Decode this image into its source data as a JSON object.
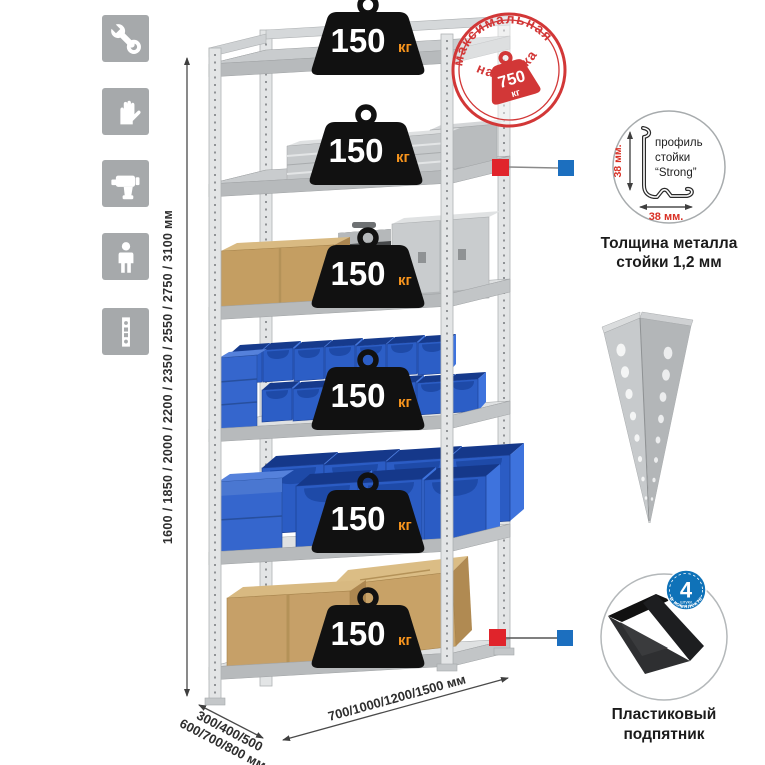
{
  "features_icons": [
    {
      "name": "wrench-icon"
    },
    {
      "name": "gloves-icon"
    },
    {
      "name": "drill-icon"
    },
    {
      "name": "person-icon"
    },
    {
      "name": "upright-profile-icon"
    }
  ],
  "dimensions": {
    "height_label": "1600 / 1850 / 2000 / 2200 / 2350 / 2550 / 2750 / 3100 мм",
    "depth_label_line1": "300/400/500",
    "depth_label_line2": "600/700/800 мм",
    "width_label": "700/1000/1200/1500 мм"
  },
  "shelf_badges": {
    "unit": "кг",
    "items": [
      {
        "value": "150"
      },
      {
        "value": "150"
      },
      {
        "value": "150"
      },
      {
        "value": "150"
      },
      {
        "value": "150"
      },
      {
        "value": "150"
      }
    ]
  },
  "max_load_stamp": {
    "arc_top": "максимальная",
    "arc_bottom": "нагрузка",
    "value": "750",
    "unit": "кг"
  },
  "profile_detail": {
    "labels": [
      "профиль",
      "стойки",
      "“Strong”"
    ],
    "dim_vertical": "38 мм.",
    "dim_horizontal": "38 мм.",
    "caption": [
      "Толщина металла",
      "стойки 1,2 мм"
    ]
  },
  "foot_detail": {
    "badge_value": "4",
    "badge_unit": "штуки",
    "badge_arc": "в комплекте",
    "caption": [
      "Пластиковый",
      "подпятник"
    ]
  },
  "colors": {
    "accent_red": "#d23737",
    "callout_red": "#e0242b",
    "callout_blue": "#1c6fbf",
    "bin_blue": "#2c5ec6",
    "metal_gray": "#d6d8da",
    "cardboard": "#c6a068",
    "badge_black": "#111111",
    "badge_unit_orange": "#f7941d",
    "icon_gray": "#a6a9ab"
  }
}
